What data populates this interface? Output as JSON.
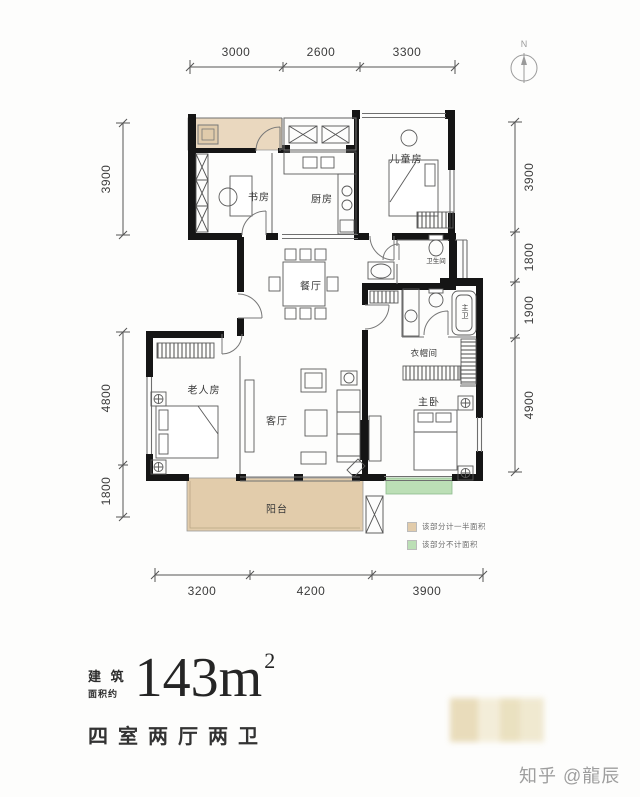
{
  "page": {
    "background": "#fdfdfc"
  },
  "compass": {
    "north_label": "N"
  },
  "dimensions": {
    "top": [
      "3000",
      "2600",
      "3300"
    ],
    "right": [
      "3900",
      "1800",
      "1900",
      "4900"
    ],
    "left": [
      "3900",
      "4800",
      "1800"
    ],
    "bottom": [
      "3200",
      "4200",
      "3900"
    ]
  },
  "rooms": {
    "study": "书房",
    "kitchen": "厨房",
    "children_room": "儿童房",
    "dining": "餐厅",
    "bathroom": "卫生间",
    "master_bath": "主卫",
    "cloakroom": "衣帽间",
    "elder_room": "老人房",
    "living": "客厅",
    "master_bedroom": "主卧",
    "balcony": "阳台"
  },
  "legend": {
    "items": [
      {
        "label": "该部分计一半面积",
        "color": "#e2ccab"
      },
      {
        "label": "该部分不计面积",
        "color": "#bcdfb6"
      }
    ]
  },
  "summary": {
    "prefix_line1": "建 筑",
    "prefix_line2": "面积约",
    "area_number": "143m",
    "area_exponent": "2",
    "layout_text": "四室两厅两卫"
  },
  "watermark": {
    "text": "知乎 @龍辰"
  },
  "colors": {
    "wall": "#151515",
    "half_area_fill": "#ead8bf",
    "balcony_fill": "#e2ccab",
    "excluded_fill": "#bcdfb6"
  }
}
